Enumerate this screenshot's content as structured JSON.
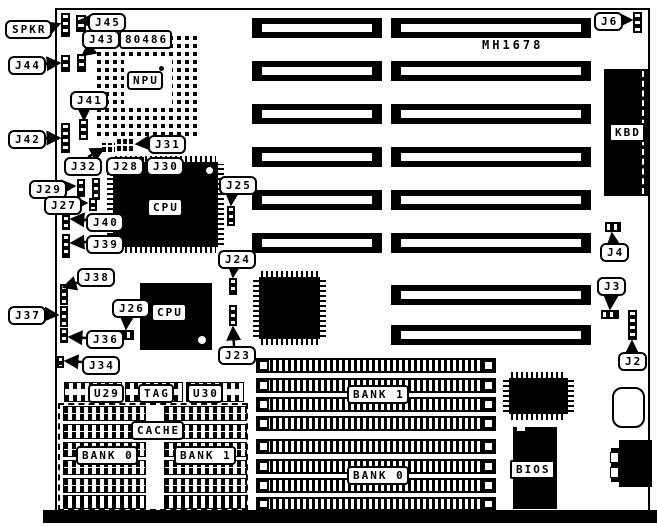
{
  "board": {
    "model": "MH1678"
  },
  "callouts": {
    "spkr": "SPKR",
    "j45": "J45",
    "j43": "J43",
    "j44": "J44",
    "j41": "J41",
    "j42": "J42",
    "j31": "J31",
    "j32": "J32",
    "j28": "J28",
    "j30": "J30",
    "j29": "J29",
    "j27": "J27",
    "j40": "J40",
    "j39": "J39",
    "j38": "J38",
    "j37": "J37",
    "j36": "J36",
    "j34": "J34",
    "j26": "J26",
    "j25": "J25",
    "j24": "J24",
    "j23": "J23",
    "j6": "J6",
    "j4": "J4",
    "j3": "J3",
    "j2": "J2"
  },
  "chips": {
    "socket486": "80486",
    "npu": "NPU",
    "cpu_top": "CPU",
    "cpu_bottom": "CPU",
    "kbd": "KBD",
    "bios": "BIOS"
  },
  "cache": {
    "u29": "U29",
    "tag": "TAG",
    "u30": "U30",
    "label": "CACHE",
    "bank0": "BANK 0",
    "bank1": "BANK 1"
  },
  "memory": {
    "bank_top": "BANK 1",
    "bank_bottom": "BANK 0"
  }
}
